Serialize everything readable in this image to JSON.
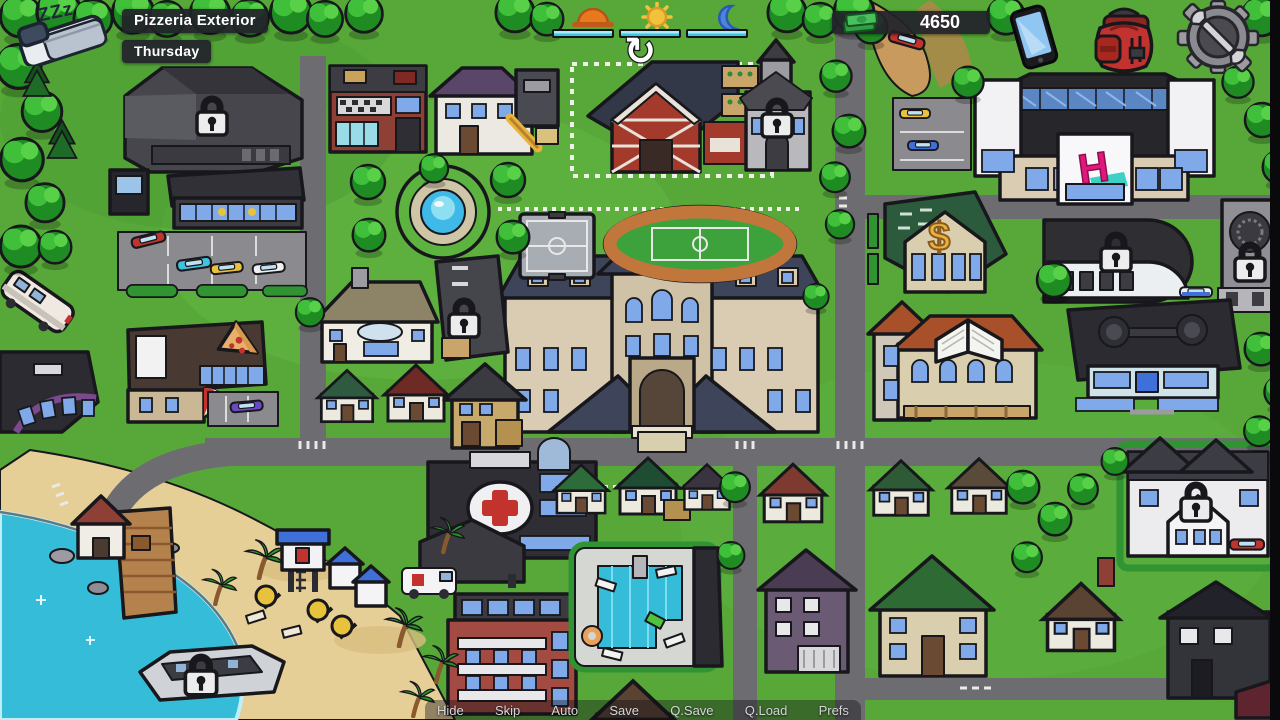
{
  "header": {
    "location": "Pizzeria Exterior",
    "day": "Thursday"
  },
  "sleep_button": {
    "label": "ZZz",
    "icon": "bed-icon"
  },
  "time_widget": {
    "phase_icons": [
      "sunrise-icon",
      "sun-icon",
      "moon-icon"
    ],
    "segments_total": 3,
    "segments_filled": 3,
    "bar_color": "#41c4e0",
    "refresh_glyph": "↻"
  },
  "money": {
    "amount": "4650",
    "icon": "cash-icon"
  },
  "top_right_buttons": [
    {
      "icon": "phone-icon"
    },
    {
      "icon": "backpack-icon"
    },
    {
      "icon": "settings-gear-wrench-icon"
    }
  ],
  "quick_menu": {
    "items": [
      {
        "label": "Hide"
      },
      {
        "label": "Skip"
      },
      {
        "label": "Auto"
      },
      {
        "label": "Save"
      },
      {
        "label": "Q.Save"
      },
      {
        "label": "Q.Load"
      },
      {
        "label": "Prefs"
      }
    ]
  },
  "map": {
    "mall_logo": "H",
    "bank_symbol": "$",
    "lock_icon": "padlock-icon",
    "locked_locations_visible": 7
  },
  "colors": {
    "label_bg": "#22222a",
    "label_text": "#ffffff",
    "grass": "#57a839",
    "road": "#6d6d71",
    "water": "#35bcd8",
    "sand": "#e6cf97",
    "money_green": "#3fae4f",
    "logo_pink": "#e0187c",
    "gold": "#e8b23c"
  }
}
